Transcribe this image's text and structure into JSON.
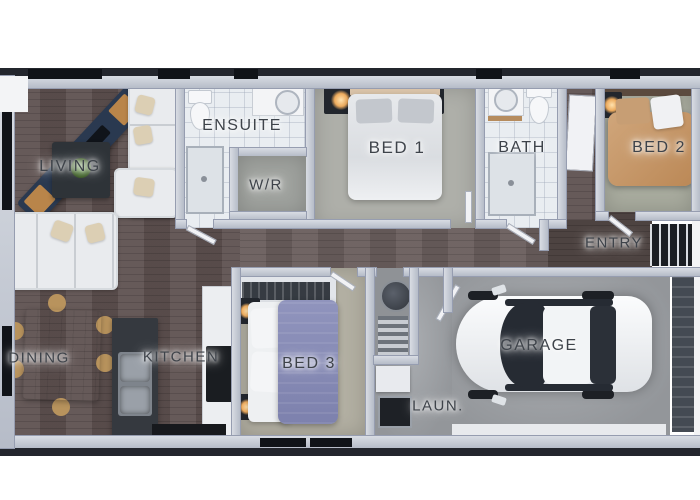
{
  "rooms": [
    {
      "id": "living",
      "label": "LIVING"
    },
    {
      "id": "ensuite",
      "label": "ENSUITE"
    },
    {
      "id": "wr",
      "label": "W/R"
    },
    {
      "id": "bed1",
      "label": "BED 1"
    },
    {
      "id": "bath",
      "label": "BATH"
    },
    {
      "id": "bed2",
      "label": "BED 2"
    },
    {
      "id": "entry",
      "label": "ENTRY"
    },
    {
      "id": "dining",
      "label": "DINING"
    },
    {
      "id": "kitchen",
      "label": "KITCHEN"
    },
    {
      "id": "bed3",
      "label": "BED 3"
    },
    {
      "id": "laundry",
      "label": "LAUN."
    },
    {
      "id": "garage",
      "label": "GARAGE"
    }
  ],
  "colors": {
    "outer_wall": "#23262d",
    "inner_wall": "#c3c8d3",
    "wood_floor": "#5e5150",
    "tile_floor": "#e9edf1",
    "carpet_bed1": "#aeafa9",
    "carpet_bed2": "#a8ab9e",
    "carpet_bed3": "#b2afa2",
    "carpet_wr": "#9fa29e",
    "concrete": "#9da0a4",
    "label_text": "#3e434a",
    "bed2_duvet": "#c59a6d",
    "bed3_duvet": "#8387b3",
    "bed1_duvet": "#e3e5e8",
    "dining_table": "#c7a679",
    "kitchen_island": "#35393f",
    "car_body": "#f4f5f7",
    "lamp_glow": "#edab5e"
  }
}
